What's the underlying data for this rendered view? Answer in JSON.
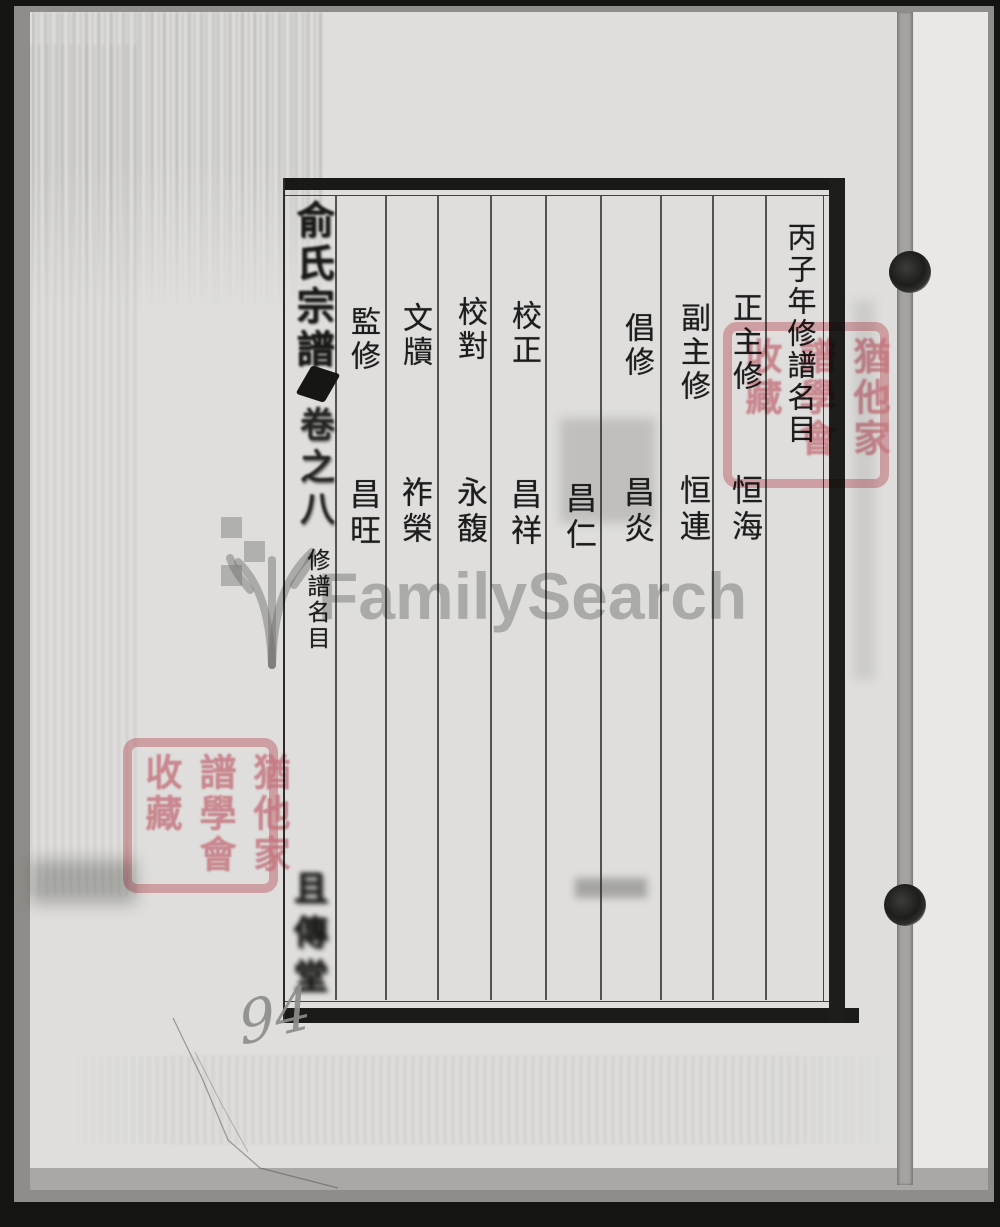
{
  "spine": {
    "title": "俞氏宗譜",
    "volume": "卷之八",
    "section": "修譜名目",
    "hall_mark": "且傳堂"
  },
  "table": {
    "header": "丙子年修譜名目",
    "entries": [
      {
        "role": "正主修",
        "name": "恒海"
      },
      {
        "role": "副主修",
        "name": "恒連"
      },
      {
        "role": "倡修",
        "name": "昌炎"
      },
      {
        "role": "",
        "name": "昌仁"
      },
      {
        "role": "校正",
        "name": "昌祥"
      },
      {
        "role": "校對",
        "name": "永馥"
      },
      {
        "role": "文牘",
        "name": "祚榮"
      },
      {
        "role": "監修",
        "name": "昌旺"
      }
    ]
  },
  "seal": {
    "columns": [
      "猶他家",
      "譜學會",
      "收藏"
    ]
  },
  "watermark": {
    "text": "FamilySearch"
  },
  "handwriting": {
    "page_number": "94"
  },
  "colors": {
    "paper": "#dfdedc",
    "ink": "#1d1d1b",
    "seal_red": "#df8a95",
    "watermark_gray": "#7d7d7a",
    "edge_black": "#141413"
  }
}
